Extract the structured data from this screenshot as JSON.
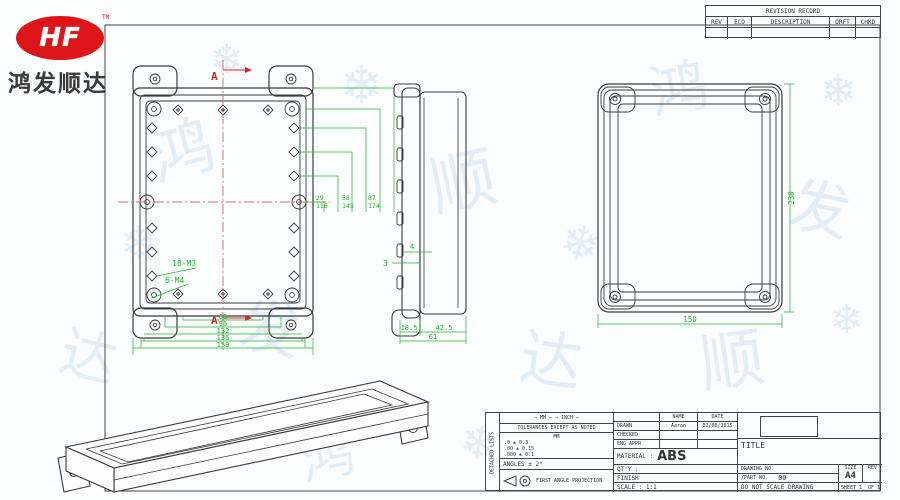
{
  "logo": {
    "monogram": "HF",
    "trademark": "TM",
    "company_name": "鸿发顺达"
  },
  "revision_table": {
    "title": "REVISION RECORD",
    "col_rev": "REV",
    "col_eco": "ECO",
    "col_description": "DESCRIPTION",
    "col_drft": "DRFT",
    "col_chkd": "CHKD"
  },
  "plan_view": {
    "section_marker_top": "A",
    "section_marker_bottom": "A",
    "label_small_bosses": "18-M3",
    "label_large_bosses": "6-M4",
    "width_dims": [
      "66",
      "96",
      "132",
      "136",
      "150"
    ],
    "pitch_dims": [
      "29",
      "58",
      "87",
      "116",
      "145",
      "174"
    ]
  },
  "side_view": {
    "thickness_dim": "3",
    "rib_dim": "4",
    "lid_depth_dim": "18.5",
    "base_depth_dim": "42.5",
    "total_depth_dim": "61"
  },
  "lid_view": {
    "width_dim": "150",
    "height_dim": "230"
  },
  "title_block": {
    "side_label": "DETACHED LISTS",
    "units_row": "→ MM ←  → INCH ←",
    "tolerance_heading": "TOLERANCES EXCEPT AS NOTED",
    "tol_unit_header": "MM",
    "tol_rows": [
      ".0  ± 0.3",
      ".00 ± 0.15",
      ".000 ± 0.1"
    ],
    "angles_row": "ANGLES ± 2°",
    "projection_label": "FIRST ANGLE PROJECTION",
    "header_name": "NAME",
    "header_date": "DATE",
    "drawn_label": "DRAWN",
    "drawn_name": "Aaron",
    "drawn_date": "02/06/2015",
    "checked_label": "CHECKED",
    "eng_appr_label": "ENG APPR",
    "material_label": "MATERIAL :",
    "material_value": "ABS",
    "qty_label": "QT'Y :",
    "finish_label": "FINISH",
    "scale_label": "SCALE : 1:1",
    "title_label": "TITLE",
    "drawing_no_label": "DRAWING NO.",
    "part_no_label": "/PART NO.",
    "part_no_value": "00",
    "size_label": "SIZE",
    "size_value": "A4",
    "rev_label": "REV",
    "do_not_scale": "DO NOT SCALE DRAWING",
    "sheet_text": "SHEET 1",
    "of_text": "OF 1"
  },
  "watermarks": {
    "items": [
      {
        "g": "鸿",
        "x": 150,
        "y": 120,
        "s": 64,
        "r": -15
      },
      {
        "g": "发",
        "x": 240,
        "y": 300,
        "s": 60,
        "r": 10
      },
      {
        "g": "顺",
        "x": 430,
        "y": 150,
        "s": 66,
        "r": -12
      },
      {
        "g": "达",
        "x": 520,
        "y": 330,
        "s": 62,
        "r": 8
      },
      {
        "g": "鸿",
        "x": 650,
        "y": 60,
        "s": 58,
        "r": -10
      },
      {
        "g": "发",
        "x": 790,
        "y": 180,
        "s": 60,
        "r": 12
      },
      {
        "g": "顺",
        "x": 700,
        "y": 330,
        "s": 64,
        "r": -8
      },
      {
        "g": "达",
        "x": 60,
        "y": 330,
        "s": 56,
        "r": 14
      },
      {
        "g": "❄",
        "x": 340,
        "y": 60,
        "s": 52,
        "r": 0
      },
      {
        "g": "❄",
        "x": 560,
        "y": 220,
        "s": 48,
        "r": 15
      },
      {
        "g": "❄",
        "x": 120,
        "y": 220,
        "s": 46,
        "r": 0
      },
      {
        "g": "❄",
        "x": 820,
        "y": 70,
        "s": 44,
        "r": 0
      },
      {
        "g": "❄",
        "x": 460,
        "y": 420,
        "s": 46,
        "r": 10
      },
      {
        "g": "❄",
        "x": 830,
        "y": 300,
        "s": 40,
        "r": 0
      },
      {
        "g": "鸿",
        "x": 300,
        "y": 430,
        "s": 54,
        "r": -12
      },
      {
        "g": "❄",
        "x": 210,
        "y": 40,
        "s": 40,
        "r": 0
      }
    ]
  }
}
